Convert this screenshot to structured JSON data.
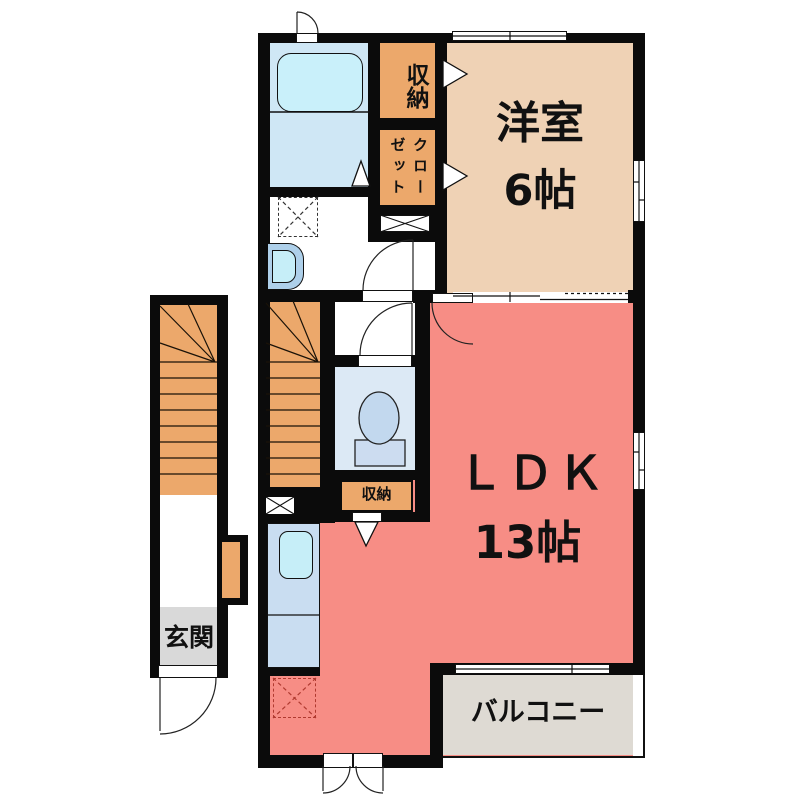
{
  "labels": {
    "western_room": "洋室",
    "western_room_size": "6帖",
    "ldk": "ＬＤＫ",
    "ldk_size": "13帖",
    "balcony": "バルコニー",
    "entrance": "玄関",
    "storage_upper": "収納",
    "closet": "クローゼット",
    "storage_wc": "収納"
  },
  "colors": {
    "wall": "#0b0b0b",
    "western_room": "#efd2b5",
    "ldk": "#f78d85",
    "stairs_storage_orange": "#eca86b",
    "balcony": "#dedad3",
    "entrance_floor": "#d9d9d9",
    "bathroom": "#cfe7f5",
    "bathtub": "#c9f0fa",
    "kitchen_counter": "#c9ddf1",
    "sink": "#c6eef8",
    "toilet_room": "#dce9f5",
    "fridge_space_mark": "#b03a30",
    "background": "#ffffff"
  }
}
